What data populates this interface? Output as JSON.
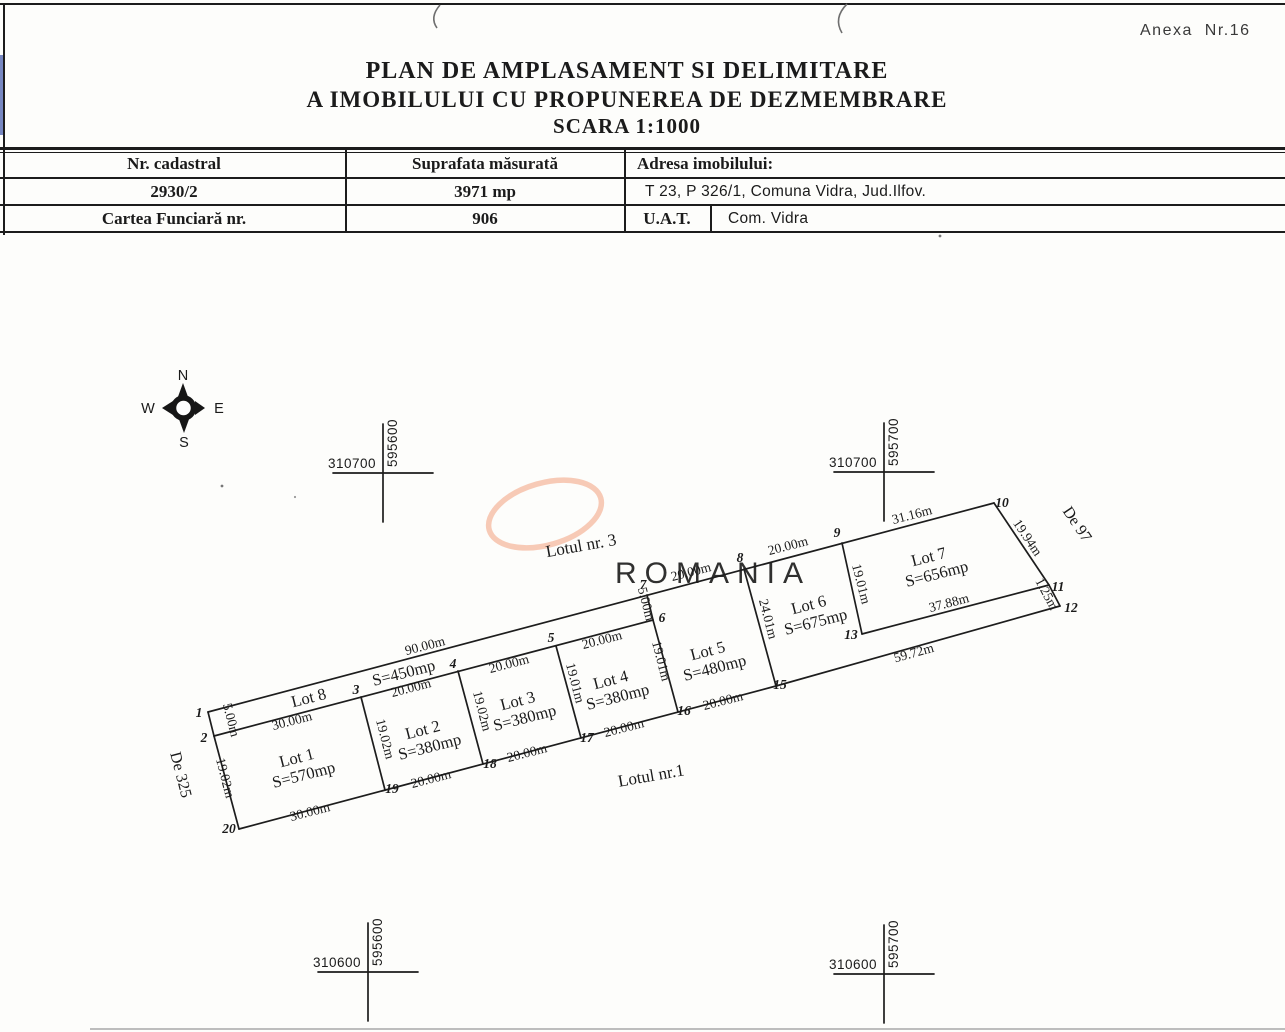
{
  "page": {
    "annex_note": "Anexa  Nr.16",
    "title_line1": "PLAN DE AMPLASAMENT SI DELIMITARE",
    "title_line2": "A IMOBILULUI CU PROPUNEREA DE DEZMEMBRARE",
    "title_line3": "SCARA 1:1000"
  },
  "info_table": {
    "headers": {
      "nr_cadastral": "Nr. cadastral",
      "suprafata": "Suprafata măsurată",
      "adresa": "Adresa imobilului:"
    },
    "values": {
      "nr_cadastral": "2930/2",
      "suprafata": "3971 mp",
      "adresa": "T 23, P 326/1, Comuna Vidra, Jud.Ilfov."
    },
    "row3": {
      "label": "Cartea Funciară nr.",
      "value": "906",
      "uat_label": "U.A.T.",
      "uat_value": "Com. Vidra"
    }
  },
  "compass": {
    "north": "N",
    "south": "S",
    "east": "E",
    "west": "W"
  },
  "watermark": {
    "text": "ROMANIA",
    "text_color": "#f4b2a0",
    "ring_color": "#f6c4ae"
  },
  "grid_crosses": [
    {
      "x": 383,
      "y": 473,
      "northing": "310700",
      "easting": "595600"
    },
    {
      "x": 884,
      "y": 472,
      "northing": "310700",
      "easting": "595700"
    },
    {
      "x": 368,
      "y": 972,
      "northing": "310600",
      "easting": "595600"
    },
    {
      "x": 884,
      "y": 974,
      "northing": "310600",
      "easting": "595700"
    }
  ],
  "plan": {
    "points": {
      "1": [
        208,
        712
      ],
      "2": [
        214,
        736
      ],
      "3": [
        361,
        697
      ],
      "4": [
        458,
        671
      ],
      "5": [
        556,
        646
      ],
      "6": [
        653,
        620
      ],
      "7": [
        647,
        595
      ],
      "8": [
        744,
        569
      ],
      "9": [
        842,
        543
      ],
      "10": [
        994,
        503
      ],
      "11": [
        1049,
        585
      ],
      "12": [
        1060,
        606
      ],
      "13": [
        862,
        634
      ],
      "15": [
        776,
        686
      ],
      "16": [
        678,
        712
      ],
      "17": [
        581,
        738
      ],
      "18": [
        483,
        764
      ],
      "19": [
        385,
        790
      ],
      "20": [
        239,
        829
      ]
    },
    "segments": [
      [
        "1",
        "10"
      ],
      [
        "10",
        "11"
      ],
      [
        "11",
        "12"
      ],
      [
        "12",
        "15"
      ],
      [
        "15",
        "20"
      ],
      [
        "20",
        "2"
      ],
      [
        "2",
        "1"
      ],
      [
        "2",
        "6"
      ],
      [
        "6",
        "7"
      ],
      [
        "3",
        "19"
      ],
      [
        "4",
        "18"
      ],
      [
        "5",
        "17"
      ],
      [
        "6",
        "16"
      ],
      [
        "8",
        "15"
      ],
      [
        "9",
        "13"
      ],
      [
        "13",
        "11"
      ]
    ],
    "point_labels": [
      {
        "t": "1",
        "x": 199,
        "y": 717
      },
      {
        "t": "2",
        "x": 204,
        "y": 742
      },
      {
        "t": "3",
        "x": 356,
        "y": 694
      },
      {
        "t": "4",
        "x": 453,
        "y": 668
      },
      {
        "t": "5",
        "x": 551,
        "y": 642
      },
      {
        "t": "6",
        "x": 662,
        "y": 622
      },
      {
        "t": "7",
        "x": 643,
        "y": 589
      },
      {
        "t": "8",
        "x": 740,
        "y": 562
      },
      {
        "t": "9",
        "x": 837,
        "y": 537
      },
      {
        "t": "10",
        "x": 1002,
        "y": 507
      },
      {
        "t": "11",
        "x": 1058,
        "y": 591
      },
      {
        "t": "12",
        "x": 1071,
        "y": 612
      },
      {
        "t": "13",
        "x": 851,
        "y": 639
      },
      {
        "t": "15",
        "x": 780,
        "y": 689
      },
      {
        "t": "16",
        "x": 684,
        "y": 715
      },
      {
        "t": "17",
        "x": 587,
        "y": 742
      },
      {
        "t": "18",
        "x": 490,
        "y": 768
      },
      {
        "t": "19",
        "x": 392,
        "y": 793
      },
      {
        "t": "20",
        "x": 229,
        "y": 833
      }
    ],
    "dimensions": [
      {
        "t": "90.00m",
        "x": 426,
        "y": 650,
        "r": -14.5
      },
      {
        "t": "30.00m",
        "x": 293,
        "y": 725,
        "r": -14.5
      },
      {
        "t": "30.00m",
        "x": 311,
        "y": 816,
        "r": -14.5
      },
      {
        "t": "20.00m",
        "x": 412,
        "y": 692,
        "r": -14.5
      },
      {
        "t": "20.00m",
        "x": 510,
        "y": 668,
        "r": -14.5
      },
      {
        "t": "20.00m",
        "x": 603,
        "y": 644,
        "r": -14.5
      },
      {
        "t": "20.00m",
        "x": 692,
        "y": 576,
        "r": -14.5
      },
      {
        "t": "20.00m",
        "x": 789,
        "y": 550,
        "r": -14.5
      },
      {
        "t": "31.16m",
        "x": 913,
        "y": 519,
        "r": -14.5
      },
      {
        "t": "20.00m",
        "x": 432,
        "y": 783,
        "r": -14.5
      },
      {
        "t": "20.00m",
        "x": 528,
        "y": 757,
        "r": -14.5
      },
      {
        "t": "20.00m",
        "x": 625,
        "y": 732,
        "r": -14.5
      },
      {
        "t": "20.00m",
        "x": 724,
        "y": 705,
        "r": -14.5
      },
      {
        "t": "37.88m",
        "x": 950,
        "y": 607,
        "r": -14.5
      },
      {
        "t": "59.72m",
        "x": 915,
        "y": 657,
        "r": -15.5
      },
      {
        "t": "5.00m",
        "x": 227,
        "y": 721,
        "r": 75.5
      },
      {
        "t": "19.02m",
        "x": 221,
        "y": 779,
        "r": 75.5
      },
      {
        "t": "19.02m",
        "x": 381,
        "y": 740,
        "r": 75.5
      },
      {
        "t": "19.02m",
        "x": 478,
        "y": 712,
        "r": 75.5
      },
      {
        "t": "19.01m",
        "x": 571,
        "y": 684,
        "r": 75.5
      },
      {
        "t": "19.01m",
        "x": 657,
        "y": 662,
        "r": 75.5
      },
      {
        "t": "5.00m",
        "x": 642,
        "y": 605,
        "r": 75.5
      },
      {
        "t": "24.01m",
        "x": 764,
        "y": 620,
        "r": 75.5
      },
      {
        "t": "19.01m",
        "x": 857,
        "y": 585,
        "r": 75.5
      },
      {
        "t": "19.94m",
        "x": 1024,
        "y": 540,
        "r": 56
      },
      {
        "t": "1.25m",
        "x": 1043,
        "y": 596,
        "r": 62
      }
    ],
    "lots": [
      {
        "name": "Lot 8",
        "area": "S=450mp",
        "nx": 310,
        "ny": 703,
        "ax": 405,
        "ay": 678,
        "r": -14.5
      },
      {
        "name": "Lot 1",
        "area": "S=570mp",
        "nx": 298,
        "ny": 763,
        "ax": 305,
        "ay": 780,
        "r": -14.5
      },
      {
        "name": "Lot 2",
        "area": "S=380mp",
        "nx": 424,
        "ny": 735,
        "ax": 431,
        "ay": 752,
        "r": -14.5
      },
      {
        "name": "Lot 3",
        "area": "S=380mp",
        "nx": 519,
        "ny": 706,
        "ax": 526,
        "ay": 723,
        "r": -14.5
      },
      {
        "name": "Lot 4",
        "area": "S=380mp",
        "nx": 612,
        "ny": 685,
        "ax": 619,
        "ay": 702,
        "r": -14.5
      },
      {
        "name": "Lot 5",
        "area": "S=480mp",
        "nx": 709,
        "ny": 656,
        "ax": 716,
        "ay": 673,
        "r": -14.5
      },
      {
        "name": "Lot 6",
        "area": "S=675mp",
        "nx": 810,
        "ny": 610,
        "ax": 817,
        "ay": 627,
        "r": -14.5
      },
      {
        "name": "Lot 7",
        "area": "S=656mp",
        "nx": 930,
        "ny": 562,
        "ax": 938,
        "ay": 579,
        "r": -14.5
      }
    ],
    "road_labels": [
      {
        "t": "De 325",
        "x": 176,
        "y": 776,
        "r": 75.5
      },
      {
        "t": "De 97",
        "x": 1073,
        "y": 527,
        "r": 56
      }
    ],
    "zone_labels": [
      {
        "t": "Lotul nr. 3",
        "x": 582,
        "y": 551,
        "r": -10
      },
      {
        "t": "Lotul nr.1",
        "x": 652,
        "y": 781,
        "r": -10
      }
    ]
  }
}
